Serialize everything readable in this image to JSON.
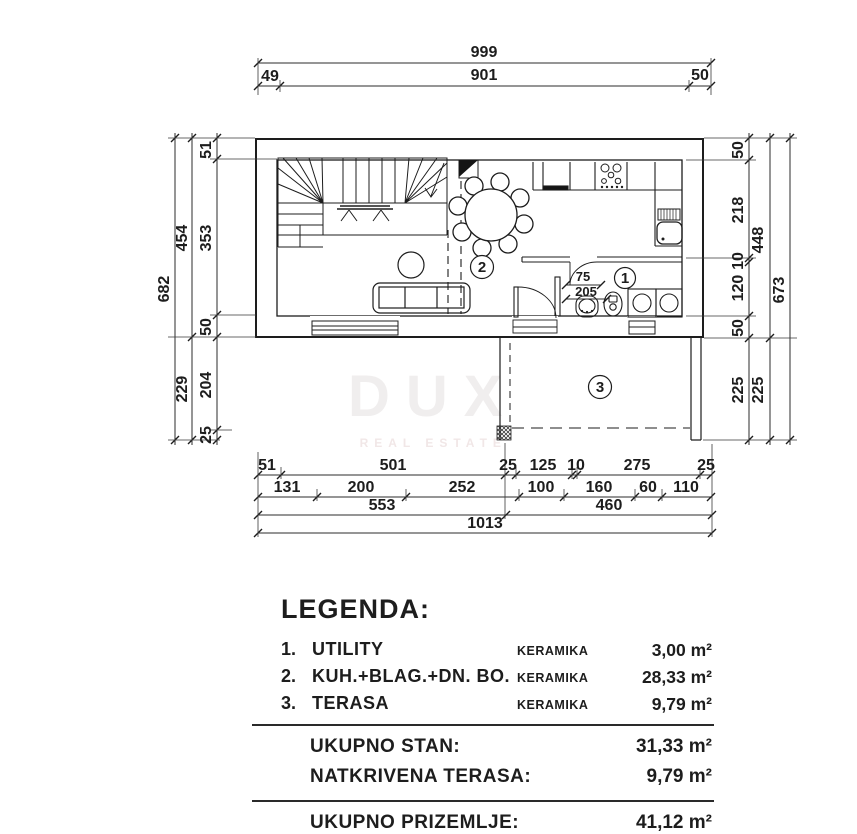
{
  "watermark": {
    "title": "DUX",
    "subtitle": "REAL ESTATE"
  },
  "plan": {
    "room_numbers": [
      "1",
      "2",
      "3"
    ],
    "dims": {
      "top": [
        "999",
        "49",
        "901",
        "50"
      ],
      "left": [
        "682",
        "454",
        "229",
        "51",
        "353",
        "50",
        "204",
        "25"
      ],
      "right": [
        "50",
        "218",
        "10",
        "120",
        "50",
        "225",
        "448",
        "225",
        "673"
      ],
      "bottom1": [
        "51",
        "501",
        "25",
        "125",
        "10",
        "275",
        "25"
      ],
      "bottom2": [
        "131",
        "200",
        "252",
        "100",
        "160",
        "60",
        "110"
      ],
      "bottom3": [
        "553",
        "460"
      ],
      "bottom4": [
        "1013"
      ],
      "inner": [
        "75",
        "205"
      ]
    }
  },
  "legend": {
    "title": "LEGENDA:",
    "items": [
      {
        "num": "1.",
        "name": "UTILITY",
        "material": "KERAMIKA",
        "area": "3,00 m²"
      },
      {
        "num": "2.",
        "name": "KUH.+BLAG.+DN. BO.",
        "material": "KERAMIKA",
        "area": "28,33 m²"
      },
      {
        "num": "3.",
        "name": "TERASA",
        "material": "KERAMIKA",
        "area": "9,79 m²"
      }
    ],
    "totals": [
      {
        "label": "UKUPNO STAN:",
        "value": "31,33 m²"
      },
      {
        "label": "NATKRIVENA TERASA:",
        "value": "9,79 m²"
      },
      {
        "label": "UKUPNO PRIZEMLJE:",
        "value": "41,12 m²"
      }
    ]
  }
}
